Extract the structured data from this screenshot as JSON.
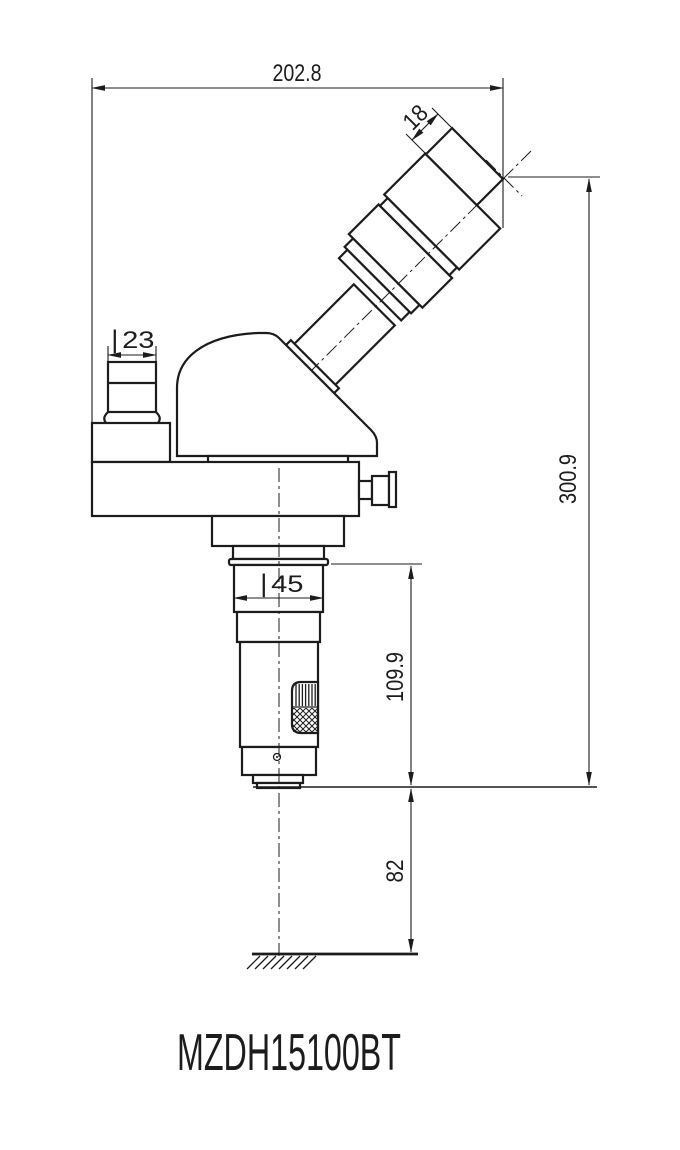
{
  "drawing": {
    "model": "MZDH15100BT",
    "dimensions": {
      "overall_width": "202.8",
      "eyepiece_section": "18",
      "port_diameter": "∣23",
      "barrel_diameter": "∣45",
      "barrel_length": "109.9",
      "overall_height": "300.9",
      "working_distance": "82"
    },
    "colors": {
      "line": "#1c1c1c",
      "background": "#ffffff"
    }
  }
}
